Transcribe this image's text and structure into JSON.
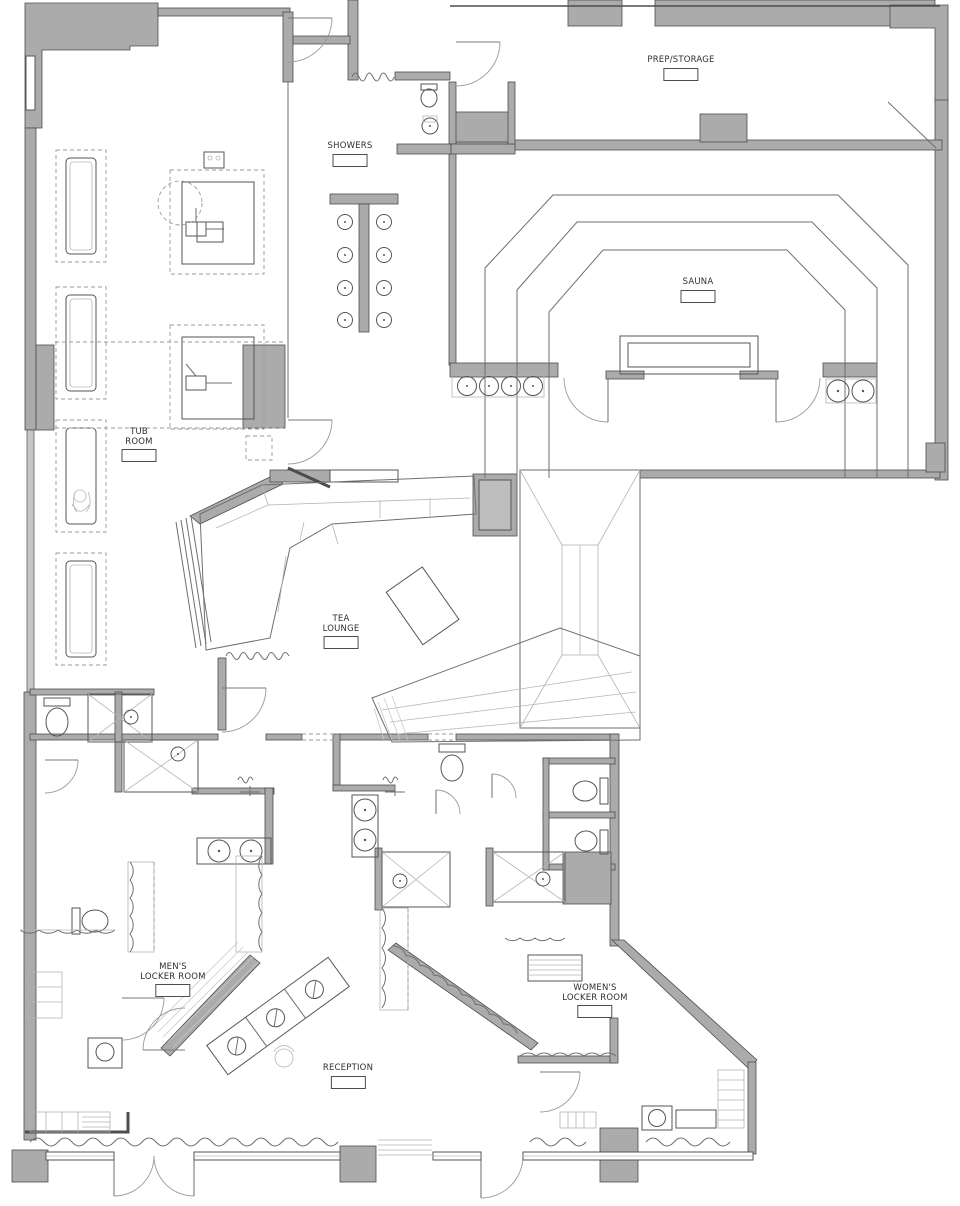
{
  "plan": {
    "type": "architectural-floor-plan",
    "description": "Spa / bathhouse floor plan with tub room, showers, sauna, tea lounge, locker rooms and reception",
    "colors": {
      "wall": "#ababab",
      "line": "#4d4d4d",
      "background": "#ffffff"
    },
    "rooms": [
      {
        "id": "prep-storage",
        "lines": [
          "PREP/STORAGE"
        ]
      },
      {
        "id": "showers",
        "lines": [
          "SHOWERS"
        ]
      },
      {
        "id": "sauna",
        "lines": [
          "SAUNA"
        ]
      },
      {
        "id": "tub-room",
        "lines": [
          "TUB",
          "ROOM"
        ]
      },
      {
        "id": "tea-lounge",
        "lines": [
          "TEA",
          "LOUNGE"
        ]
      },
      {
        "id": "mens-locker-room",
        "lines": [
          "MEN'S",
          "LOCKER ROOM"
        ]
      },
      {
        "id": "womens-locker-room",
        "lines": [
          "WOMEN'S",
          "LOCKER ROOM"
        ]
      },
      {
        "id": "reception",
        "lines": [
          "RECEPTION"
        ]
      }
    ]
  }
}
